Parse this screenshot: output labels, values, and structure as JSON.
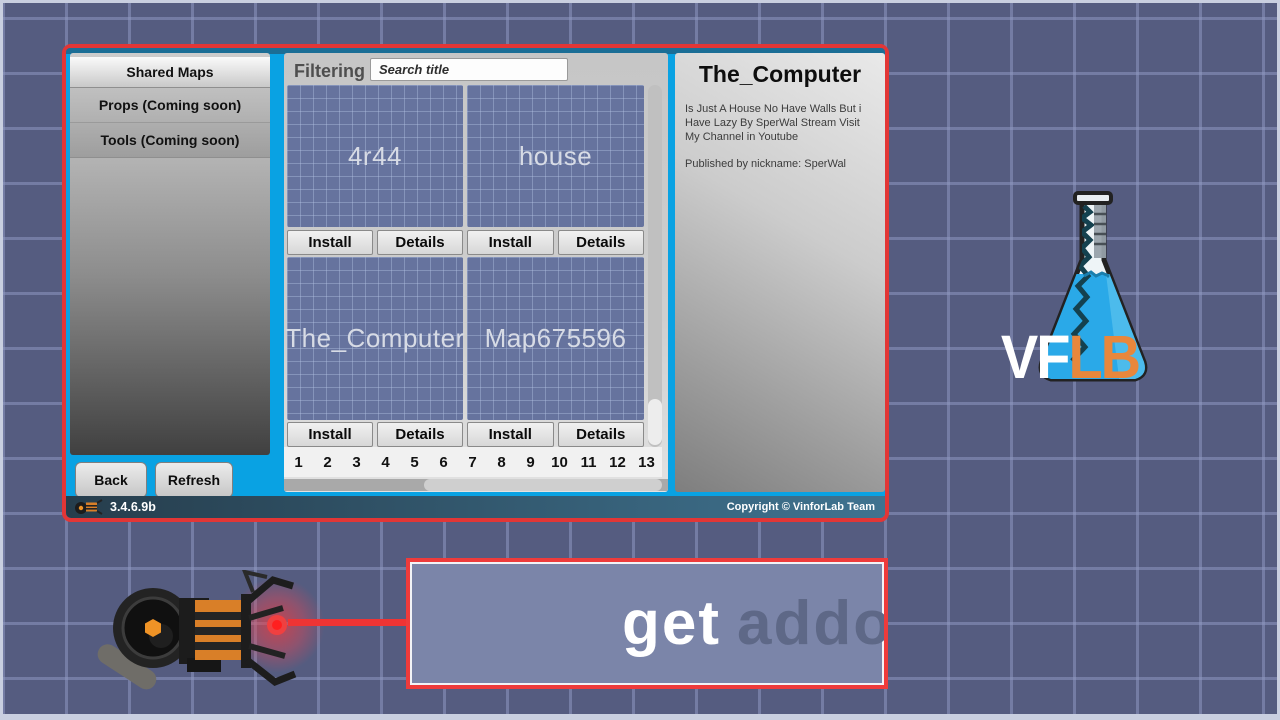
{
  "dialog": {
    "sidebar": {
      "items": [
        {
          "label": "Shared Maps",
          "selected": true
        },
        {
          "label": "Props (Coming soon)",
          "selected": false
        },
        {
          "label": "Tools (Coming soon)",
          "selected": false
        }
      ],
      "back_label": "Back",
      "refresh_label": "Refresh"
    },
    "browser": {
      "filtering_label": "Filtering",
      "search_placeholder": "Search title",
      "cards": [
        {
          "title": "4r44",
          "install_label": "Install",
          "details_label": "Details"
        },
        {
          "title": "house",
          "install_label": "Install",
          "details_label": "Details"
        },
        {
          "title": "The_Computer",
          "install_label": "Install",
          "details_label": "Details"
        },
        {
          "title": "Map675596",
          "install_label": "Install",
          "details_label": "Details"
        }
      ],
      "pages": [
        "1",
        "2",
        "3",
        "4",
        "5",
        "6",
        "7",
        "8",
        "9",
        "10",
        "11",
        "12",
        "13",
        "14"
      ]
    },
    "details_panel": {
      "title": "The_Computer",
      "description_lines": [
        "Is Just A House No Have Walls But i",
        "Have Lazy By SperWal Stream Visit",
        "My Channel in Youtube"
      ],
      "published": "Published by nickname: SperWal"
    },
    "status_bar": {
      "version": "3.4.6.9b",
      "copyright": "Copyright © VinforLab Team"
    }
  },
  "logo": {
    "text_white": "VF",
    "text_orange": "LB"
  },
  "tooltip": {
    "text_primary": "get",
    "text_secondary": "addons"
  },
  "colors": {
    "dialog_border": "#e23636",
    "dialog_accent_cyan": "#09a2e3",
    "background_tile": "#555c80",
    "background_grid_line": "#8f98c0",
    "card_background": "#66739e",
    "beam_red": "#ee3434",
    "logo_orange": "#e8873c",
    "tooltip_fill": "#7b85a9"
  }
}
